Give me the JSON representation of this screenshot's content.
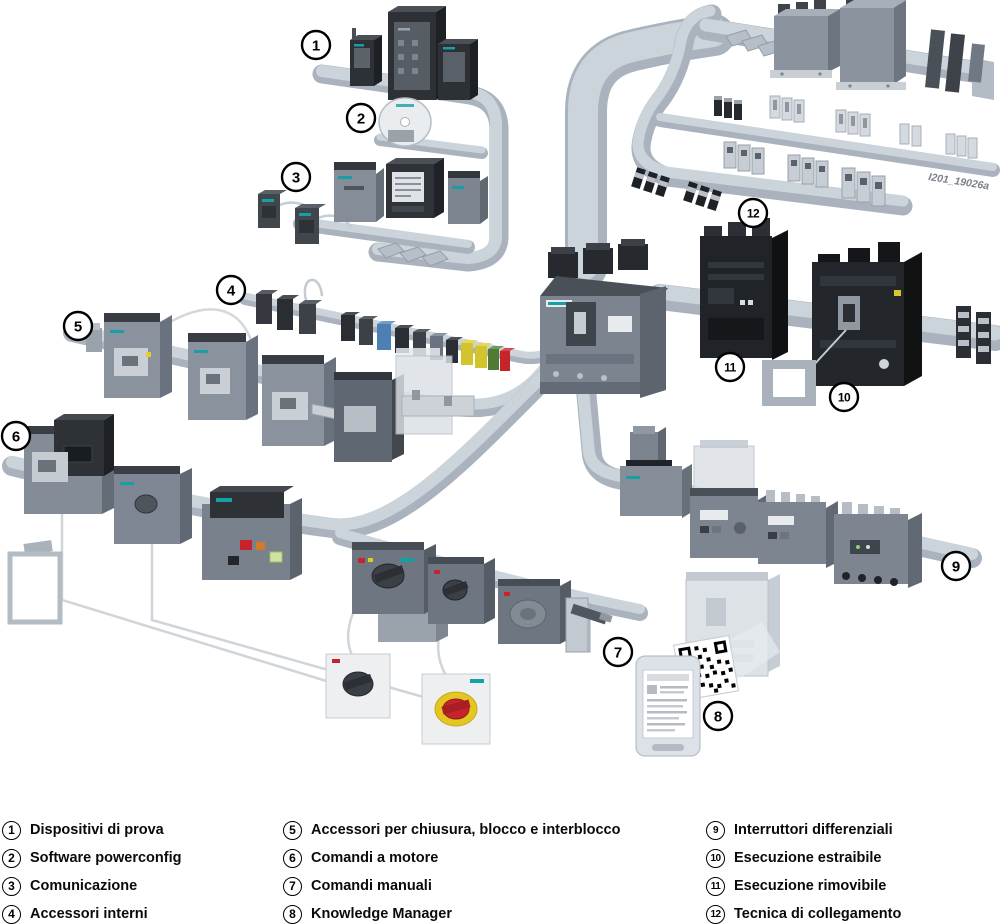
{
  "figure": {
    "code": "I201_19026a",
    "description": "Panoramica sistema interruttori scatolati con accessori"
  },
  "colors": {
    "background": "#ffffff",
    "rail": "#c7cfd7",
    "rail_shadow": "#aab3bd",
    "rail_light": "#d9dfe5",
    "device_dark": "#2d3136",
    "device_gray": "#7d8591",
    "ghost_device": "#dde2e7",
    "accent_red": "#c5242b",
    "accent_yellow": "#ddca2b",
    "accent_green": "#507a36",
    "accent_blue": "#4d7fb5",
    "legend_text": "#0a0a0a"
  },
  "callouts": [
    {
      "num": "1",
      "label": "Dispositivi di prova"
    },
    {
      "num": "2",
      "label": "Software powerconfig"
    },
    {
      "num": "3",
      "label": "Comunicazione"
    },
    {
      "num": "4",
      "label": "Accessori interni"
    },
    {
      "num": "5",
      "label": "Accessori per chiusura, blocco e interblocco"
    },
    {
      "num": "6",
      "label": "Comandi a motore"
    },
    {
      "num": "7",
      "label": "Comandi manuali"
    },
    {
      "num": "8",
      "label": "Knowledge Manager"
    },
    {
      "num": "9",
      "label": "Interruttori differenziali"
    },
    {
      "num": "10",
      "label": "Esecuzione estraibile"
    },
    {
      "num": "11",
      "label": "Esecuzione rimovibile"
    },
    {
      "num": "12",
      "label": "Tecnica di collegamento"
    }
  ]
}
